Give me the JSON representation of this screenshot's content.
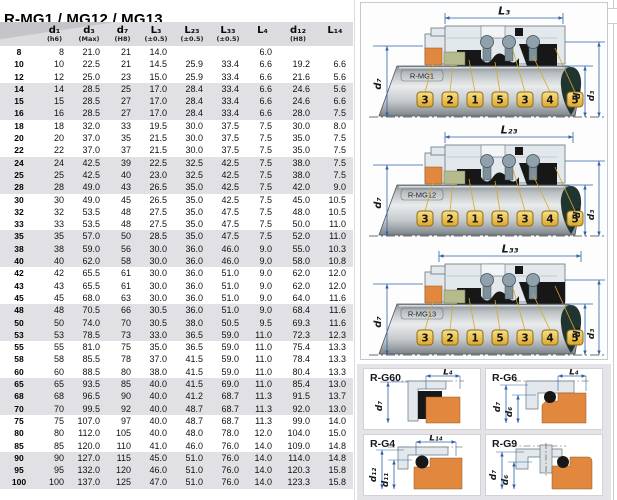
{
  "title": "R-MG1 / MG12 / MG13",
  "table": {
    "columns": [
      {
        "label": "",
        "tol": ""
      },
      {
        "label": "d₁",
        "tol": "(h6)"
      },
      {
        "label": "d₃",
        "tol": "(Max)"
      },
      {
        "label": "d₇",
        "tol": "(H8)"
      },
      {
        "label": "L₃",
        "tol": "(±0.5)"
      },
      {
        "label": "L₂₃",
        "tol": "(±0.5)"
      },
      {
        "label": "L₃₃",
        "tol": "(±0.5)"
      },
      {
        "label": "L₄",
        "tol": ""
      },
      {
        "label": "d₁₂",
        "tol": "(H8)"
      },
      {
        "label": "L₁₄",
        "tol": ""
      }
    ],
    "rows": [
      [
        "8",
        "8",
        "21.0",
        "21",
        "14.0",
        "",
        "",
        "6.0",
        "",
        ""
      ],
      [
        "10",
        "10",
        "22.5",
        "21",
        "14.5",
        "25.9",
        "33.4",
        "6.6",
        "19.2",
        "6.6"
      ],
      [
        "12",
        "12",
        "25.0",
        "23",
        "15.0",
        "25.9",
        "33.4",
        "6.6",
        "21.6",
        "5.6"
      ],
      [
        "14",
        "14",
        "28.5",
        "25",
        "17.0",
        "28.4",
        "33.4",
        "6.6",
        "24.6",
        "5.6"
      ],
      [
        "15",
        "15",
        "28.5",
        "27",
        "17.0",
        "28.4",
        "33.4",
        "6.6",
        "24.6",
        "6.6"
      ],
      [
        "16",
        "16",
        "28.5",
        "27",
        "17.0",
        "28.4",
        "33.4",
        "6.6",
        "28.0",
        "7.5"
      ],
      [
        "18",
        "18",
        "32.0",
        "33",
        "19.5",
        "30.0",
        "37.5",
        "7.5",
        "30.0",
        "8.0"
      ],
      [
        "20",
        "20",
        "37.0",
        "35",
        "21.5",
        "30.0",
        "37.5",
        "7.5",
        "35.0",
        "7.5"
      ],
      [
        "22",
        "22",
        "37.0",
        "37",
        "21.5",
        "30.0",
        "37.5",
        "7.5",
        "35.0",
        "7.5"
      ],
      [
        "24",
        "24",
        "42.5",
        "39",
        "22.5",
        "32.5",
        "42.5",
        "7.5",
        "38.0",
        "7.5"
      ],
      [
        "25",
        "25",
        "42.5",
        "40",
        "23.0",
        "32.5",
        "42.5",
        "7.5",
        "38.0",
        "7.5"
      ],
      [
        "28",
        "28",
        "49.0",
        "43",
        "26.5",
        "35.0",
        "42.5",
        "7.5",
        "42.0",
        "9.0"
      ],
      [
        "30",
        "30",
        "49.0",
        "45",
        "26.5",
        "35.0",
        "42.5",
        "7.5",
        "45.0",
        "10.5"
      ],
      [
        "32",
        "32",
        "53.5",
        "48",
        "27.5",
        "35.0",
        "47.5",
        "7.5",
        "48.0",
        "10.5"
      ],
      [
        "33",
        "33",
        "53.5",
        "48",
        "27.5",
        "35.0",
        "47.5",
        "7.5",
        "50.0",
        "11.0"
      ],
      [
        "35",
        "35",
        "57.0",
        "50",
        "28.5",
        "35.0",
        "47.5",
        "7.5",
        "52.0",
        "11.0"
      ],
      [
        "38",
        "38",
        "59.0",
        "56",
        "30.0",
        "36.0",
        "46.0",
        "9.0",
        "55.0",
        "10.3"
      ],
      [
        "40",
        "40",
        "62.0",
        "58",
        "30.0",
        "36.0",
        "46.0",
        "9.0",
        "58.0",
        "10.8"
      ],
      [
        "42",
        "42",
        "65.5",
        "61",
        "30.0",
        "36.0",
        "51.0",
        "9.0",
        "62.0",
        "12.0"
      ],
      [
        "43",
        "43",
        "65.5",
        "61",
        "30.0",
        "36.0",
        "51.0",
        "9.0",
        "62.0",
        "12.0"
      ],
      [
        "45",
        "45",
        "68.0",
        "63",
        "30.0",
        "36.0",
        "51.0",
        "9.0",
        "64.0",
        "11.6"
      ],
      [
        "48",
        "48",
        "70.5",
        "66",
        "30.5",
        "36.0",
        "51.0",
        "9.0",
        "68.4",
        "11.6"
      ],
      [
        "50",
        "50",
        "74.0",
        "70",
        "30.5",
        "38.0",
        "50.5",
        "9.5",
        "69.3",
        "11.6"
      ],
      [
        "53",
        "53",
        "78.5",
        "73",
        "33.0",
        "36.5",
        "59.0",
        "11.0",
        "72.3",
        "12.3"
      ],
      [
        "55",
        "55",
        "81.0",
        "75",
        "35.0",
        "36.5",
        "59.0",
        "11.0",
        "75.4",
        "13.3"
      ],
      [
        "58",
        "58",
        "85.5",
        "78",
        "37.0",
        "41.5",
        "59.0",
        "11.0",
        "78.4",
        "13.3"
      ],
      [
        "60",
        "60",
        "88.5",
        "80",
        "38.0",
        "41.5",
        "59.0",
        "11.0",
        "80.4",
        "13.3"
      ],
      [
        "65",
        "65",
        "93.5",
        "85",
        "40.0",
        "41.5",
        "69.0",
        "11.0",
        "85.4",
        "13.0"
      ],
      [
        "68",
        "68",
        "96.5",
        "90",
        "40.0",
        "41.2",
        "68.7",
        "11.3",
        "91.5",
        "13.7"
      ],
      [
        "70",
        "70",
        "99.5",
        "92",
        "40.0",
        "48.7",
        "68.7",
        "11.3",
        "92.0",
        "13.0"
      ],
      [
        "75",
        "75",
        "107.0",
        "97",
        "40.0",
        "48.7",
        "68.7",
        "11.3",
        "99.0",
        "14.0"
      ],
      [
        "80",
        "80",
        "112.0",
        "105",
        "40.0",
        "48.0",
        "78.0",
        "12.0",
        "104.0",
        "15.0"
      ],
      [
        "85",
        "85",
        "120.0",
        "110",
        "41.0",
        "46.0",
        "76.0",
        "14.0",
        "109.0",
        "14.8"
      ],
      [
        "90",
        "90",
        "127.0",
        "115",
        "45.0",
        "51.0",
        "76.0",
        "14.0",
        "114.0",
        "14.8"
      ],
      [
        "95",
        "95",
        "132.0",
        "120",
        "46.0",
        "51.0",
        "76.0",
        "14.0",
        "120.3",
        "15.8"
      ],
      [
        "100",
        "100",
        "137.0",
        "125",
        "47.0",
        "51.0",
        "76.0",
        "14.0",
        "123.3",
        "15.8"
      ]
    ]
  },
  "diagrams": {
    "callouts": [
      "3",
      "2",
      "1",
      "5",
      "3",
      "4",
      "5"
    ],
    "variants": [
      {
        "key": "mg1",
        "name": "R-MG1",
        "top_dim": "L₃",
        "left_dim": "d₇",
        "right_dims": [
          "d₁",
          "d₃"
        ]
      },
      {
        "key": "mg12",
        "name": "R-MG12",
        "top_dim": "L₂₃",
        "left_dim": "d₇",
        "right_dims": [
          "d₁",
          "d₃"
        ]
      },
      {
        "key": "mg13",
        "name": "R-MG13",
        "top_dim": "L₃₃",
        "left_dim": "d₇",
        "right_dims": [
          "d₁",
          "d₃"
        ]
      }
    ]
  },
  "seat_panels": [
    {
      "key": "g60",
      "name": "R-G60",
      "top_dim": "L₄",
      "left_dims": [
        "d₇"
      ]
    },
    {
      "key": "g6",
      "name": "R-G6",
      "top_dim": "L₄",
      "left_dims": [
        "d₇",
        "d₆"
      ]
    },
    {
      "key": "g4",
      "name": "R-G4",
      "top_dim": "L₁₄",
      "left_dims": [
        "d₁₂",
        "d₁₁"
      ]
    },
    {
      "key": "g9",
      "name": "R-G9",
      "top_dim": "",
      "left_dims": [
        "d₇",
        "d₆"
      ]
    }
  ],
  "colors": {
    "dim_blue": "#2e62a8",
    "callout_yellow_light": "#f8e088",
    "callout_yellow_dark": "#dda72c",
    "callout_border": "#8f6d16",
    "leader_line": "#d8a82a",
    "seat_orange": "#e2883e",
    "face_green": "#b5bb8d",
    "housing_gray": "#e2e8ec",
    "housing_stroke": "#66747e",
    "spring_gray": "#90a1ab",
    "rubber_black": "#171717",
    "drop_dark": "#203430",
    "header_bg": "#dcdce0",
    "row_alt": "#e1e1e5"
  }
}
